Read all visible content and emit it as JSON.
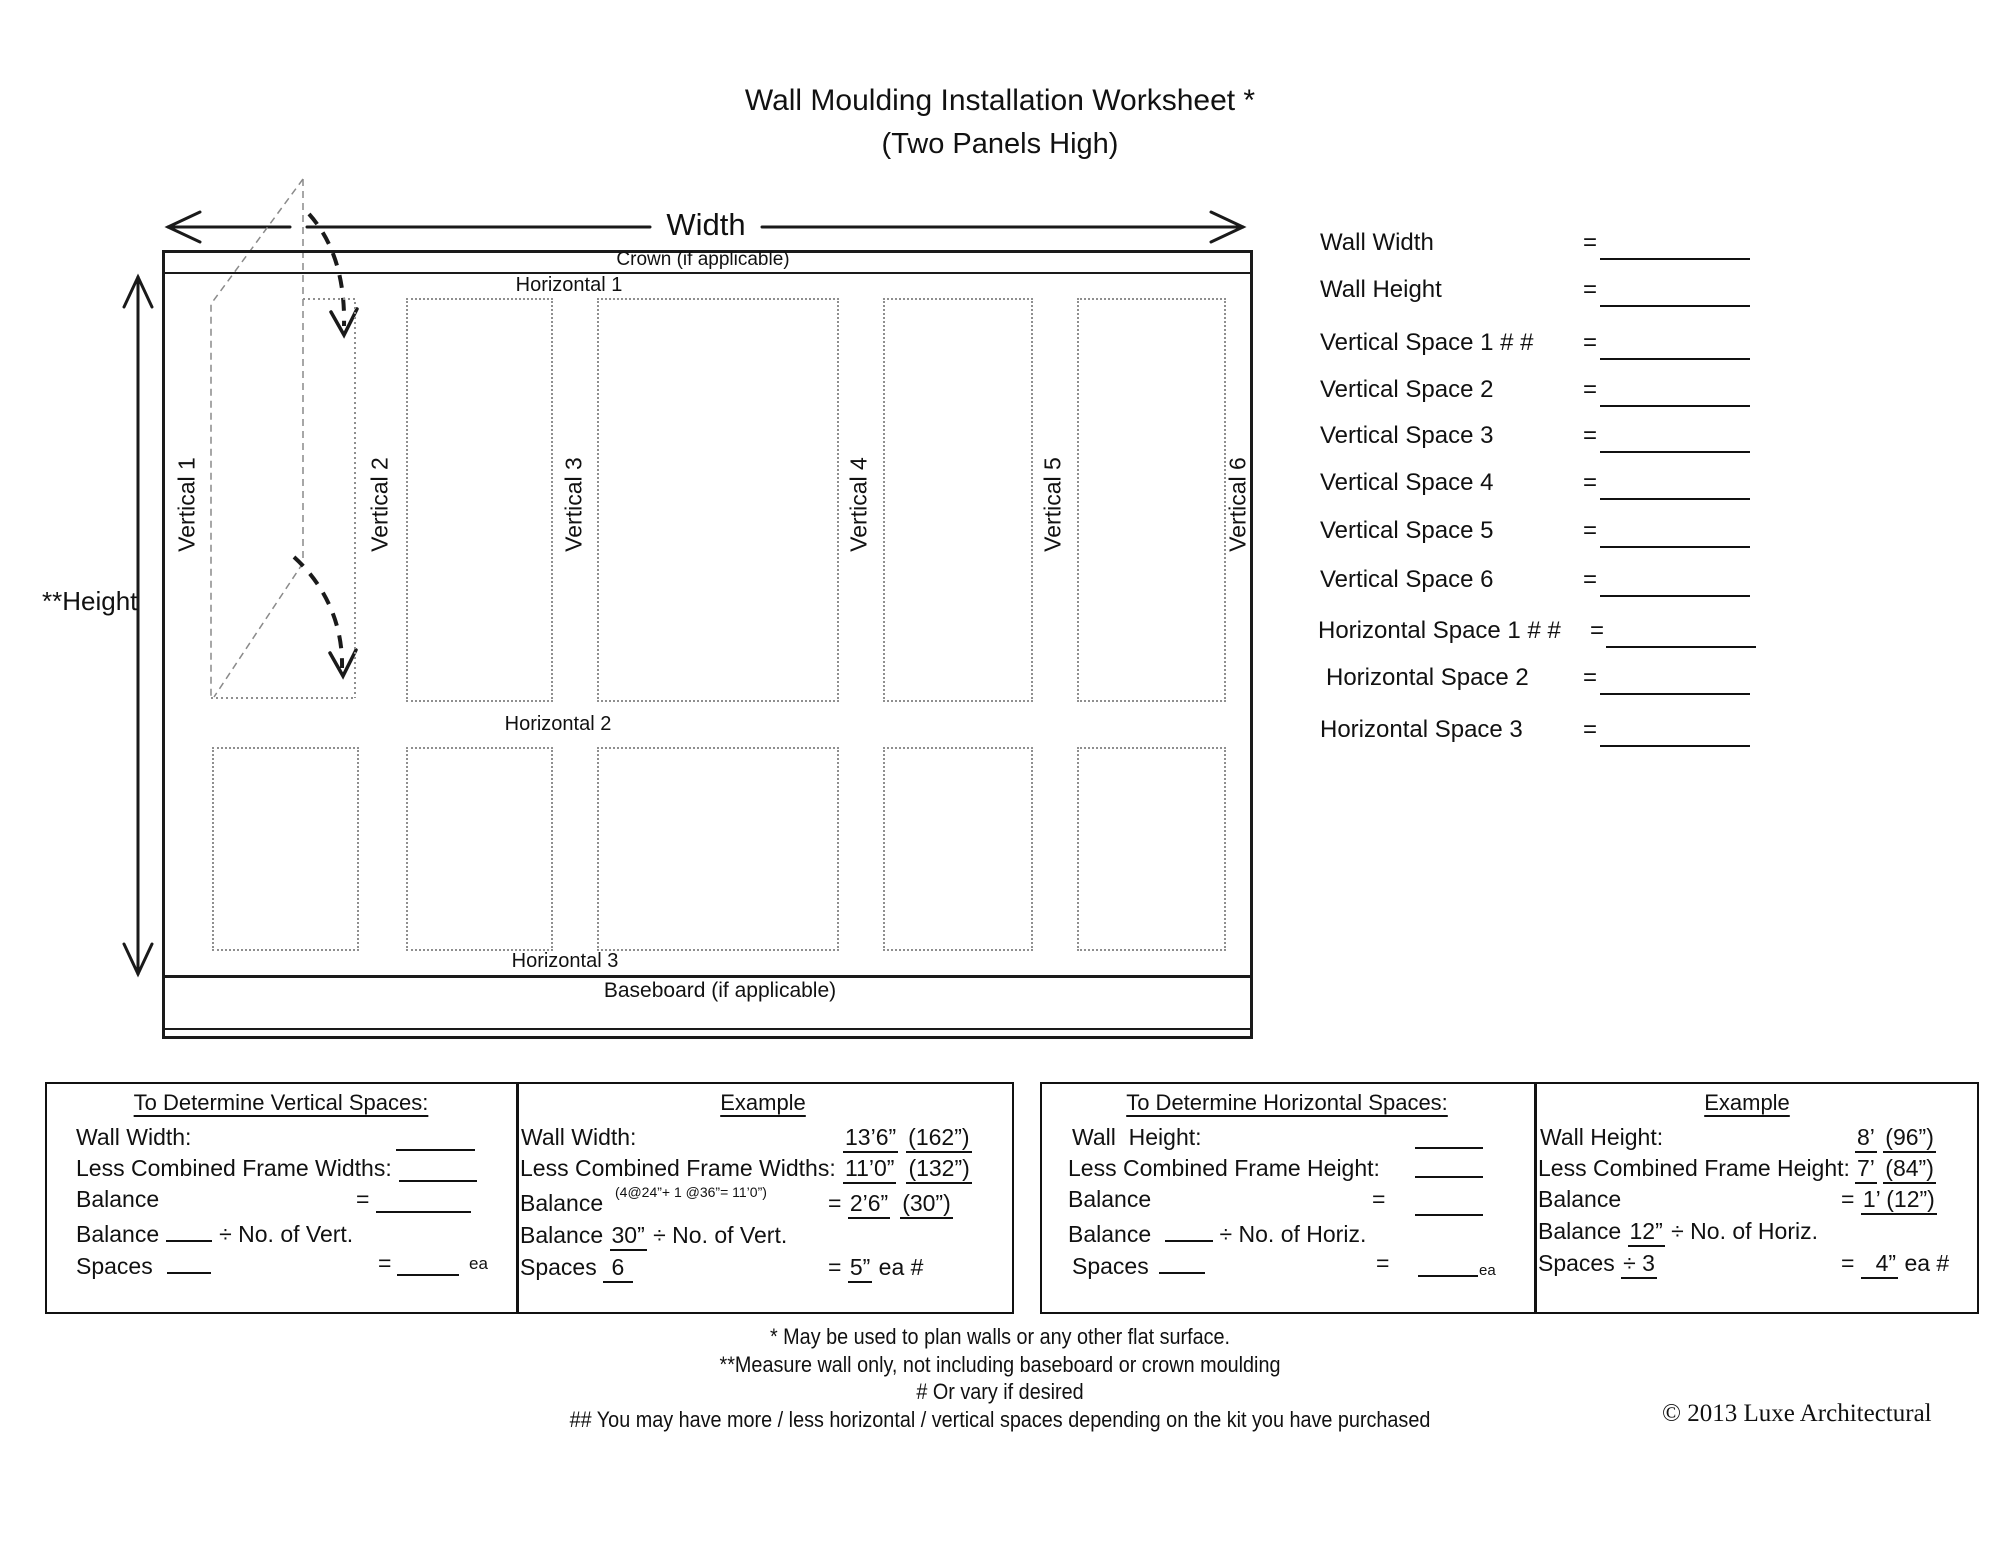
{
  "title": {
    "line1": "Wall Moulding Installation Worksheet *",
    "line2": "(Two Panels High)"
  },
  "diagram": {
    "width_label": "Width",
    "height_label": "**Height",
    "crown_label": "Crown (if applicable)",
    "horizontal_1": "Horizontal 1",
    "horizontal_2": "Horizontal 2",
    "horizontal_3": "Horizontal 3",
    "baseboard_label": "Baseboard (if applicable)",
    "verticals": [
      "Vertical 1",
      "Vertical 2",
      "Vertical 3",
      "Vertical 4",
      "Vertical 5",
      "Vertical 6"
    ]
  },
  "form": {
    "equals": "=",
    "rows": [
      {
        "label": "Wall Width"
      },
      {
        "label": "Wall Height"
      },
      {
        "label": "Vertical Space 1 # #"
      },
      {
        "label": "Vertical Space 2"
      },
      {
        "label": "Vertical Space 3"
      },
      {
        "label": "Vertical Space 4"
      },
      {
        "label": "Vertical Space 5"
      },
      {
        "label": "Vertical Space 6"
      },
      {
        "label": "Horizontal Space 1 # #"
      },
      {
        "label": "Horizontal Space 2"
      },
      {
        "label": "Horizontal Space 3"
      }
    ]
  },
  "vert_box": {
    "title": "To Determine Vertical Spaces:",
    "row1": "Wall Width:",
    "row2": "Less Combined Frame Widths:",
    "row3": "Balance",
    "row4_pre": "Balance",
    "row4_post": "÷ No. of Vert.",
    "row5": "Spaces",
    "ea": "ea"
  },
  "vert_example": {
    "title": "Example",
    "row1": "Wall Width:",
    "row1_v1": "13’6”",
    "row1_v2": "(162”)",
    "row2": "Less Combined Frame Widths:",
    "row2_v1": "11’0”",
    "row2_v2": "(132”)",
    "note": "(4@24”+ 1 @36”= 11’0”)",
    "row3": "Balance",
    "row3_v1": "2’6”",
    "row3_v2": "(30”)",
    "row4_pre": "Balance",
    "row4_u": "30”",
    "row4_post": " ÷ No. of Vert.",
    "row5_pre": "Spaces",
    "row5_u": " 6 ",
    "row5_v": "5”",
    "row5_post": " ea #"
  },
  "horiz_box": {
    "title": "To Determine Horizontal Spaces:",
    "row1": "Wall  Height:",
    "row2": "Less Combined Frame Height:",
    "row3": "Balance",
    "row4_pre": "Balance ",
    "row4_post": "÷ No. of Horiz.",
    "row5": "Spaces",
    "ea": "ea"
  },
  "horiz_example": {
    "title": "Example",
    "row1": "Wall Height:",
    "row1_v1": "8’",
    "row1_v2": "(96”)",
    "row2": "Less Combined Frame Height:",
    "row2_v1": "7’",
    "row2_v2": "(84”)",
    "row3": "Balance",
    "row3_v": "1’ (12”)",
    "row4_pre": "Balance ",
    "row4_u": "12”",
    "row4_post": " ÷ No. of Horiz.",
    "row5_pre": "Spaces ",
    "row5_u": "÷ 3",
    "row5_v": "  4”",
    "row5_post": " ea #"
  },
  "footnotes": [
    "* May be used to plan walls or any other flat surface.",
    "**Measure wall only, not including baseboard or crown moulding",
    "# Or vary if desired",
    "## You may have more / less horizontal / vertical spaces depending on the kit you have purchased"
  ],
  "copyright": "© 2013 Luxe Architectural"
}
